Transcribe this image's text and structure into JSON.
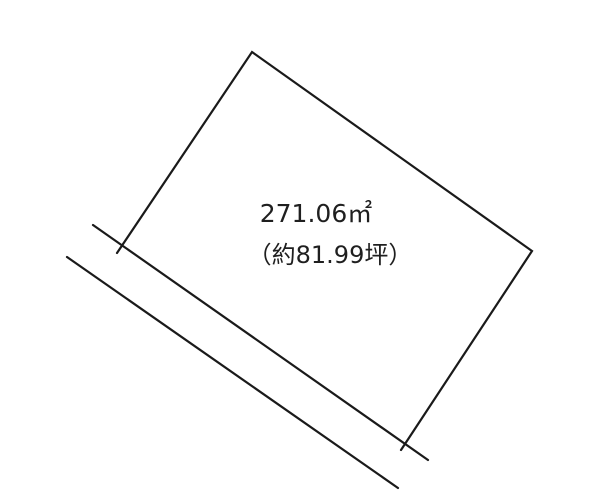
{
  "diagram": {
    "type": "land-plot-sketch",
    "area_label": "271.06㎡",
    "tsubo_label": "（約81.99坪）",
    "area_sqm": 271.06,
    "area_tsubo_approx": 81.99,
    "line_color": "#1a1a1a",
    "text_color": "#1f1f1f",
    "background_color": "#ffffff"
  }
}
